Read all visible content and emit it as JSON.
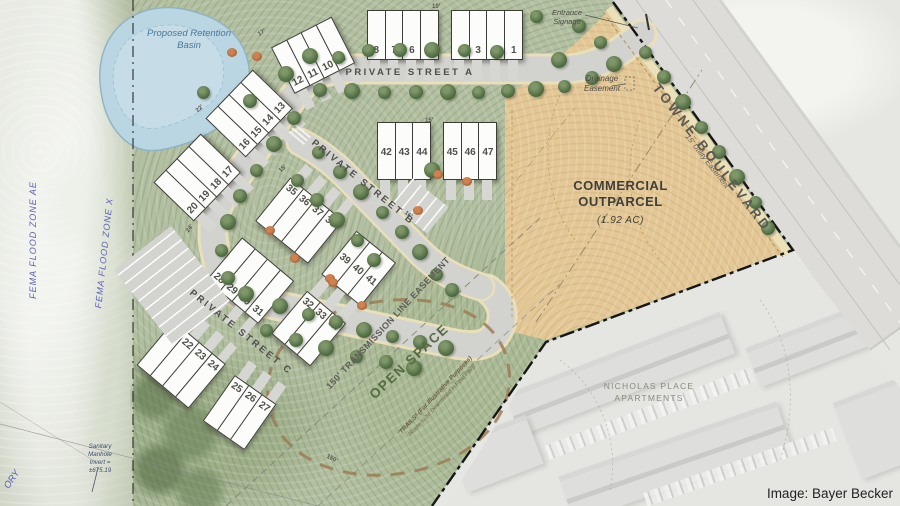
{
  "map": {
    "pond_label": "Proposed Retention Basin",
    "streets": {
      "a": "PRIVATE STREET A",
      "b": "PRIVATE STREET B",
      "c": "PRIVATE STREET C",
      "boulevard": "TOWNE BOULEVARD"
    },
    "parcels": {
      "commercial": {
        "line1": "COMMERCIAL",
        "line2": "OUTPARCEL",
        "acreage": "(1.92 AC)"
      },
      "open_space": "OPEN SPACE",
      "apartments": {
        "line1": "NICHOLAS PLACE",
        "line2": "APARTMENTS"
      }
    },
    "easements": {
      "transmission": "150' TRANSMISSION LINE EASEMENT",
      "drainage": "Drainage Easement",
      "utility": "15' Utility Easement"
    },
    "flood_zones": {
      "ae": "FEMA FLOOD ZONE AE",
      "x": "FEMA FLOOD ZONE X"
    },
    "annotations": {
      "entrance": "Entrance Signage",
      "trails_line1": "TRAILS* (For Illustrative Purposes)",
      "trails_line2": "(Route to be Determined in Final Plan)",
      "sanitary": "Sanitary Manhole Invert = ±675.19",
      "corner_fragment": "ORY"
    },
    "lot_groups": [
      {
        "name": "lots-4-1",
        "numbers": [
          "4",
          "3",
          "2",
          "1"
        ]
      },
      {
        "name": "lots-8-5",
        "numbers": [
          "8",
          "7",
          "6",
          "5"
        ]
      },
      {
        "name": "lots-12-9",
        "numbers": [
          "12",
          "11",
          "10",
          "9"
        ]
      },
      {
        "name": "lots-16-13",
        "numbers": [
          "16",
          "15",
          "14",
          "13"
        ]
      },
      {
        "name": "lots-20-17",
        "numbers": [
          "20",
          "19",
          "18",
          "17"
        ]
      },
      {
        "name": "lots-21-24",
        "numbers": [
          "21",
          "22",
          "23",
          "24"
        ]
      },
      {
        "name": "lots-25-27",
        "numbers": [
          "25",
          "26",
          "27"
        ]
      },
      {
        "name": "lots-28-31",
        "numbers": [
          "28",
          "29",
          "30",
          "31"
        ]
      },
      {
        "name": "lots-32-34",
        "numbers": [
          "32",
          "33",
          "34"
        ]
      },
      {
        "name": "lots-35-38",
        "numbers": [
          "35",
          "36",
          "37",
          "38"
        ]
      },
      {
        "name": "lots-39-41",
        "numbers": [
          "39",
          "40",
          "41"
        ]
      },
      {
        "name": "lots-42-44",
        "numbers": [
          "42",
          "43",
          "44"
        ]
      },
      {
        "name": "lots-45-47",
        "numbers": [
          "45",
          "46",
          "47"
        ]
      }
    ],
    "dimensions": [
      "10'",
      "15'",
      "17'",
      "24'",
      "16'",
      "150'",
      "22'",
      "15'"
    ],
    "credit": "Image: Bayer Becker",
    "colors": {
      "site_green": "#b2bfa0",
      "outparcel_tan": "#e3c795",
      "pond_blue": "#b9d6e2",
      "street_gray": "#d2d2cf",
      "boundary_black": "#161616",
      "fema_text": "#5d61b2",
      "open_space_text": "#566b42"
    }
  }
}
